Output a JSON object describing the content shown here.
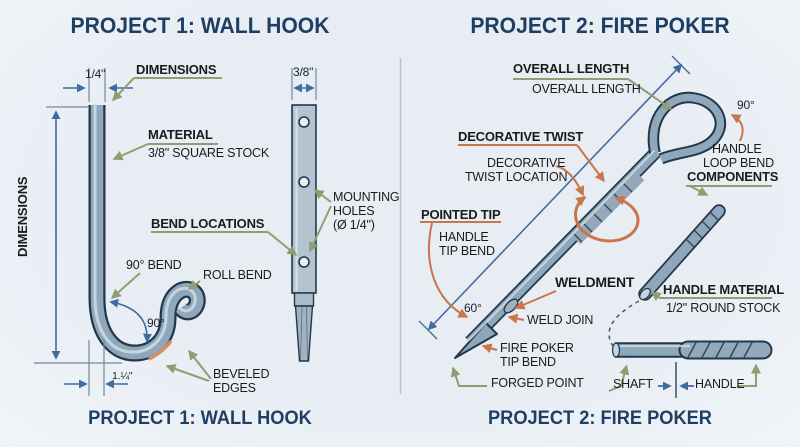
{
  "colors": {
    "background": "#e8edf4",
    "title_navy": "#1e3f63",
    "label_text": "#1b1b1b",
    "leader_green": "#8d9f72",
    "leader_orange": "#c8764a",
    "dimension_blue": "#3f6c9d",
    "steel_body": "#8ea7ba",
    "steel_outline": "#22374a"
  },
  "project1": {
    "title": "PROJECT 1: WALL HOOK",
    "footer": "PROJECT 1: WALL HOOK",
    "dims": {
      "stock_width": "1/4\"",
      "bar_width": "3/8\"",
      "hook_width": "1.¼\"",
      "bend_angle": "90°"
    },
    "labels": {
      "dimensions": "DIMENSIONS",
      "dimensions_vertical": "DIMENSIONS",
      "material": "MATERIAL",
      "material_value": "3/8\" SQUARE STOCK",
      "bend_locations": "BEND LOCATIONS",
      "bend_90": "90° BEND",
      "roll_bend": "ROLL BEND",
      "beveled_1": "BEVELED",
      "beveled_2": "EDGES",
      "mounting_1": "MOUNTING",
      "mounting_2": "HOLES",
      "mounting_3": "(Ø 1/4\")"
    }
  },
  "project2": {
    "title": "PROJECT 2: FIRE POKER",
    "footer": "PROJECT 2: FIRE POKER",
    "dims": {
      "loop_angle": "90°",
      "tip_angle": "60°"
    },
    "labels": {
      "overall_length": "OVERALL LENGTH",
      "overall_length_value": "OVERALL LENGTH",
      "decorative_twist": "DECORATIVE TWIST",
      "twist_location_1": "DECORATIVE",
      "twist_location_2": "TWIST LOCATION",
      "pointed_tip": "POINTED TIP",
      "handle_tip_1": "HANDLE",
      "handle_tip_2": "TIP BEND",
      "weldment": "WELDMENT",
      "weld_join": "WELD JOIN",
      "tip_bend_1": "FIRE POKER",
      "tip_bend_2": "TIP BEND",
      "forged_point": "FORGED POINT",
      "handle_loop_1": "HANDLE",
      "handle_loop_2": "LOOP BEND",
      "components": "COMPONENTS",
      "handle_material": "HANDLE MATERIAL",
      "handle_material_value": "1/2\" ROUND STOCK",
      "shaft": "SHAFT",
      "handle": "HANDLE"
    }
  }
}
